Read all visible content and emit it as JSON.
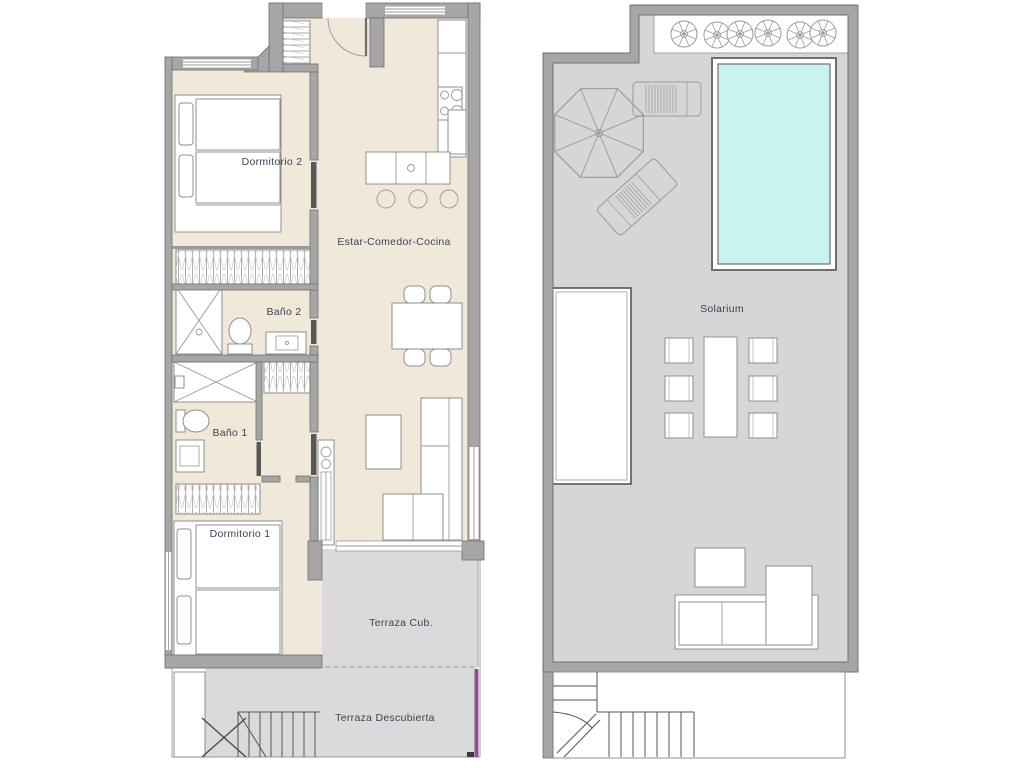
{
  "page": {
    "background": "#ffffff"
  },
  "plans": {
    "apartment": {
      "name": "apartment-floor-plan",
      "labels": {
        "dormitorio2": "Dormitorio 2",
        "estar": "Estar-Comedor-Cocina",
        "bano2": "Baño 2",
        "bano1": "Baño 1",
        "dormitorio1": "Dormitorio 1",
        "terraza_cub": "Terraza Cub.",
        "terraza_desc": "Terraza Descubierta"
      }
    },
    "roof": {
      "name": "roof-solarium-plan",
      "labels": {
        "solarium": "Solarium"
      }
    }
  },
  "colors": {
    "floor_beige": "#f0e8d8",
    "terrace_gray": "#dadada",
    "roof_floor_gray": "#d6d6d6",
    "wall_gray": "#a6a6a6",
    "wall_edge": "#707070",
    "pool_water": "#c9f3f1",
    "boundary_purple": "#8f4e93",
    "label_text": "#3d4357"
  }
}
